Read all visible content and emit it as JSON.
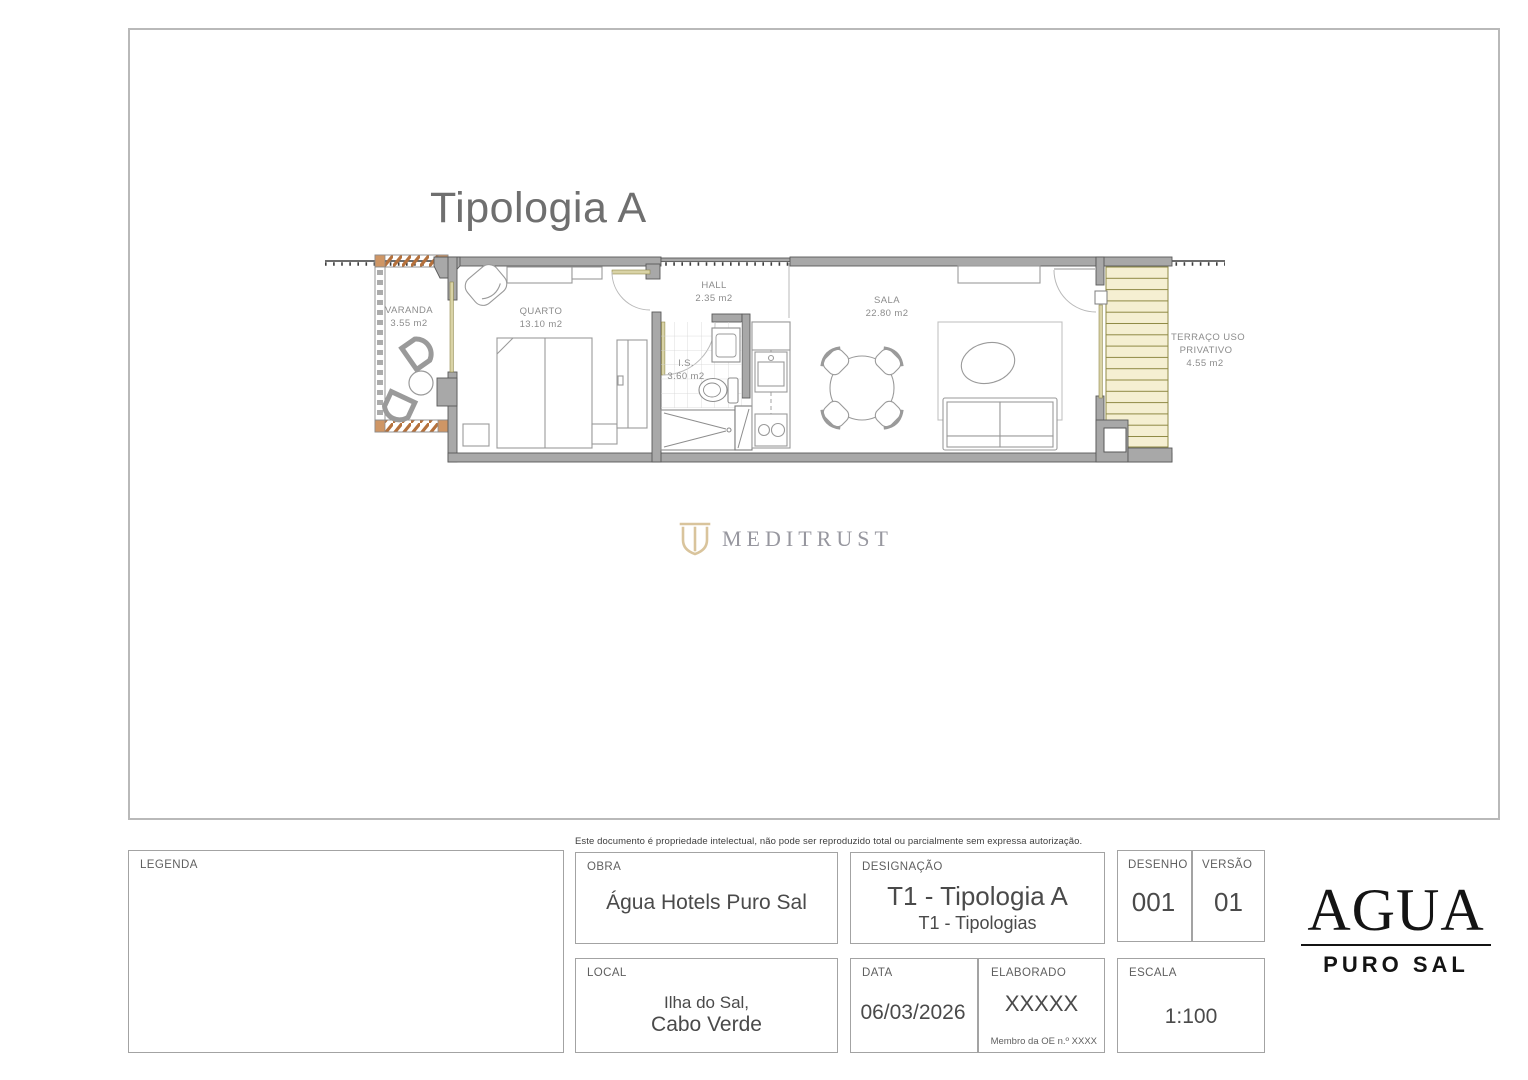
{
  "floor_plan": {
    "title": "Tipologia A",
    "rooms": [
      {
        "name": "VARANDA",
        "area": "3.55 m2"
      },
      {
        "name": "QUARTO",
        "area": "13.10 m2"
      },
      {
        "name": "HALL",
        "area": "2.35 m2"
      },
      {
        "name": "I.S.",
        "area": "3.60 m2"
      },
      {
        "name": "SALA",
        "area": "22.80 m2"
      },
      {
        "name": "TERRAÇO USO PRIVATIVO",
        "name_line1": "TERRAÇO USO",
        "name_line2": "PRIVATIVO",
        "area": "4.55 m2"
      }
    ]
  },
  "watermark": {
    "brand": "MEDITRUST"
  },
  "notice": "Este documento é propriedade intelectual, não pode ser reproduzido total ou parcialmente sem expressa autorização.",
  "title_block": {
    "legenda": {
      "label": "LEGENDA"
    },
    "obra": {
      "label": "OBRA",
      "value": "Água Hotels Puro Sal"
    },
    "designacao": {
      "label": "DESIGNAÇÃO",
      "value": "T1 - Tipologia A",
      "subvalue": "T1 - Tipologias"
    },
    "desenho": {
      "label": "DESENHO",
      "value": "001"
    },
    "versao": {
      "label": "VERSÃO",
      "value": "01"
    },
    "local": {
      "label": "LOCAL",
      "line1": "Ilha do Sal,",
      "line2": "Cabo Verde"
    },
    "data": {
      "label": "DATA",
      "value": "06/03/2026"
    },
    "elaborado": {
      "label": "ELABORADO",
      "value": "XXXXX",
      "note": "Membro da OE n.º XXXX"
    },
    "escala": {
      "label": "ESCALA",
      "value": "1:100"
    },
    "logo": {
      "name": "AGUA",
      "subtitle": "PURO SAL"
    }
  },
  "colors": {
    "wall_fill": "#a8a8a8",
    "wall_edge": "#595959",
    "furniture_line": "#9a9a9a",
    "deck_fill": "#f5efd2",
    "deck_line": "#8f8a45",
    "balcony_hatch": "#b5713c",
    "door_leaf_tan": "#d9d3a6",
    "brand_tan": "#d9c49c",
    "label_gray": "#8c8c8c"
  }
}
